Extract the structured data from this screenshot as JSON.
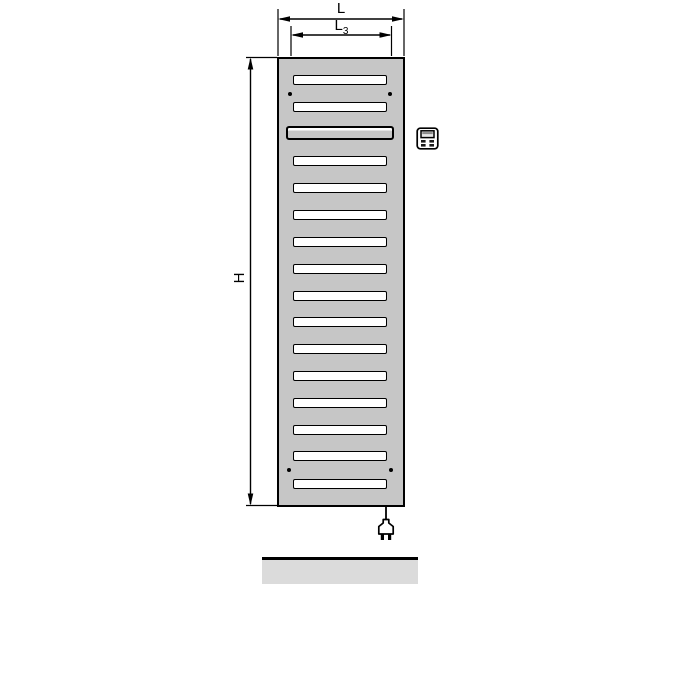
{
  "diagram": {
    "type": "technical-drawing",
    "subject": "electric bathroom radiator front view with dimension lines, plug-in cable and floor line",
    "background_color": "#ffffff",
    "line_color": "#000000",
    "labels": {
      "overall_width": "L",
      "connection_width_base": "L",
      "connection_width_sub": "3",
      "overall_height": "H"
    }
  },
  "radiator": {
    "body_fill": "#c6c6c6",
    "outline_color": "#000000",
    "slot_fill": "#ffffff",
    "slot_count": 16,
    "slots": [
      {
        "top": 16,
        "variant": "normal"
      },
      {
        "top": 43,
        "variant": "normal"
      },
      {
        "top": 67,
        "variant": "wide"
      },
      {
        "top": 97,
        "variant": "normal"
      },
      {
        "top": 124,
        "variant": "normal"
      },
      {
        "top": 151,
        "variant": "normal"
      },
      {
        "top": 178,
        "variant": "normal"
      },
      {
        "top": 205,
        "variant": "normal"
      },
      {
        "top": 232,
        "variant": "normal"
      },
      {
        "top": 258,
        "variant": "normal"
      },
      {
        "top": 285,
        "variant": "normal"
      },
      {
        "top": 312,
        "variant": "normal"
      },
      {
        "top": 339,
        "variant": "normal"
      },
      {
        "top": 366,
        "variant": "normal"
      },
      {
        "top": 392,
        "variant": "normal"
      },
      {
        "top": 420,
        "variant": "normal"
      }
    ],
    "screw_holes": [
      {
        "x": 11,
        "y": 35
      },
      {
        "x": 111,
        "y": 35
      },
      {
        "x": 10,
        "y": 411
      },
      {
        "x": 112,
        "y": 411
      }
    ]
  },
  "icons": {
    "control_unit": "control-panel-icon",
    "plug": "power-plug-icon"
  },
  "floor": {
    "fill": "#dbdbdb",
    "top_edge_color": "#000000"
  }
}
